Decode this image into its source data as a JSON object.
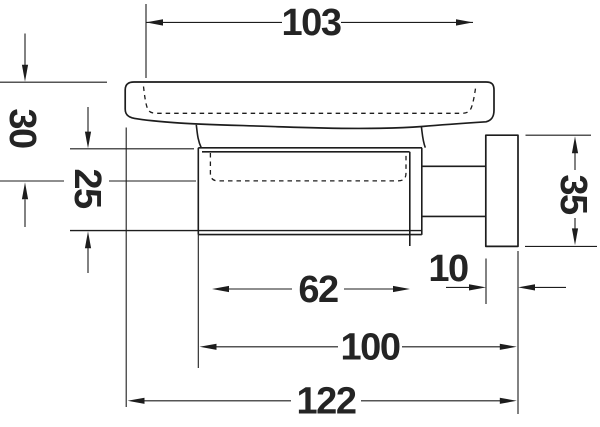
{
  "drawing": {
    "background": "#ffffff",
    "line_color": "#1d1d1d",
    "text_color": "#242424",
    "dimensions": {
      "dish_inner_width": "103",
      "dish_height": "30",
      "holder_height": "25",
      "wall_plate_height": "35",
      "holder_inner_width": "62",
      "wall_plate_depth": "10",
      "holder_depth_from_wall": "100",
      "overall_depth": "122"
    }
  }
}
